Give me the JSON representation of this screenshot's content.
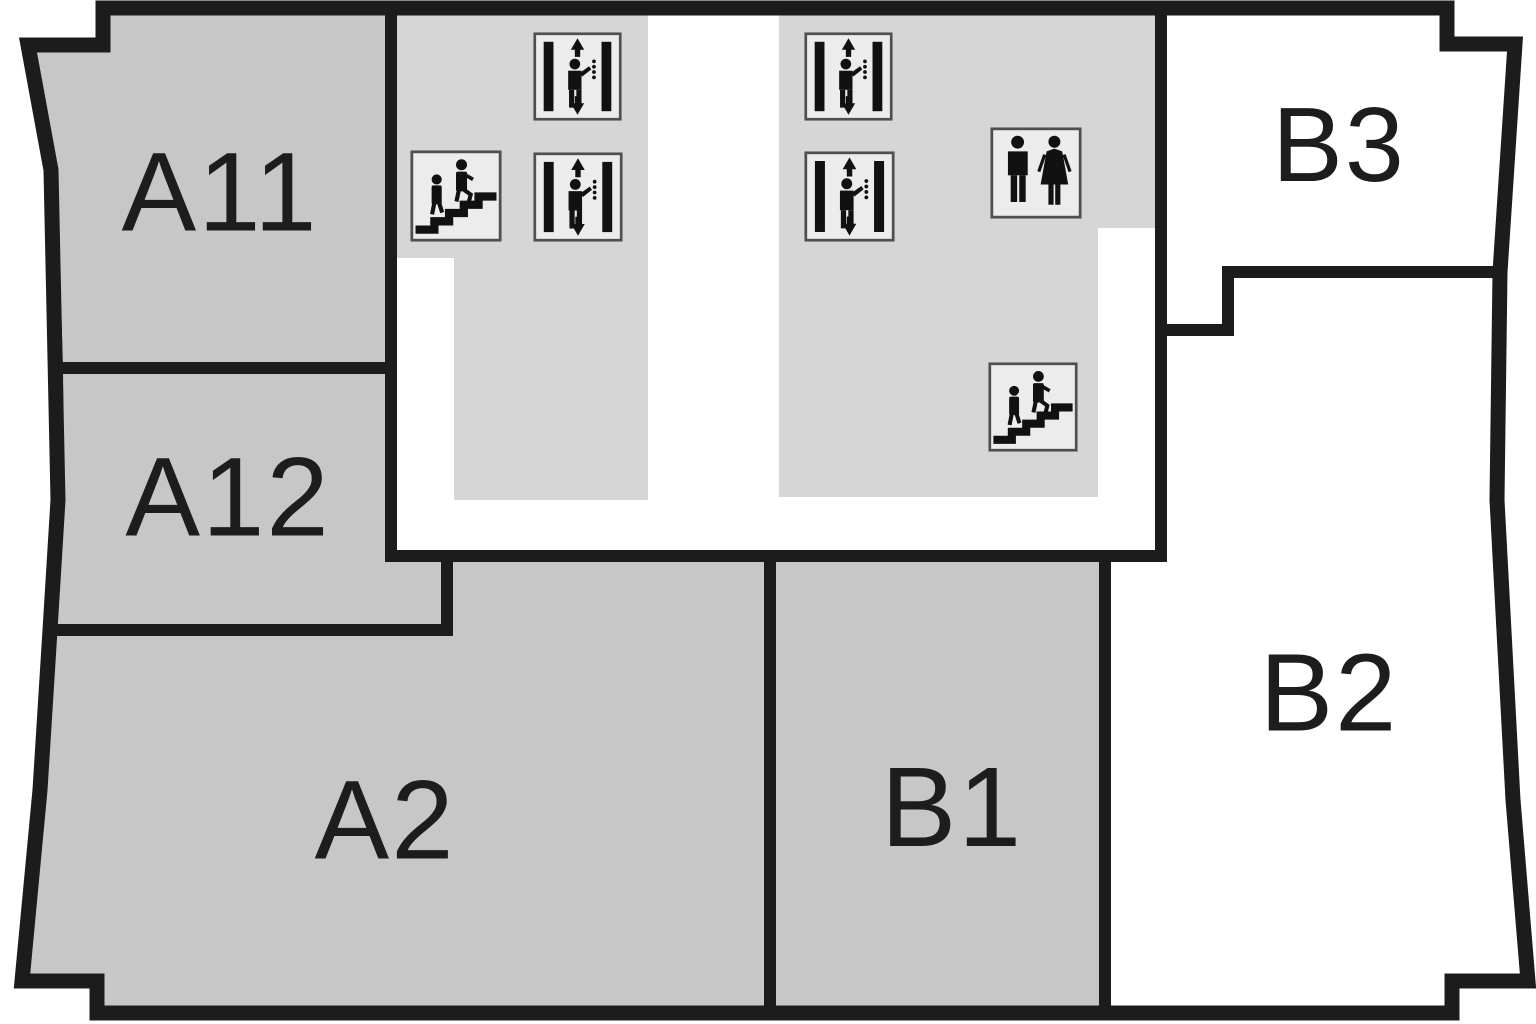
{
  "canvas": {
    "width": 1536,
    "height": 1024,
    "background": "#ffffff"
  },
  "colors": {
    "wall": "#1c1c1c",
    "room_fill": "#c7c7c7",
    "hall_fill": "#d6d6d6",
    "white_room_fill": "#ffffff",
    "icon_bg": "#ececec",
    "icon_border": "#4f4f4f",
    "ink": "#111111",
    "label": "#1d1d1d"
  },
  "outline": {
    "points": [
      [
        103,
        8
      ],
      [
        1447,
        8
      ],
      [
        1447,
        44
      ],
      [
        1515,
        44
      ],
      [
        1500,
        272
      ],
      [
        1497,
        500
      ],
      [
        1513,
        800
      ],
      [
        1528,
        981
      ],
      [
        1452,
        981
      ],
      [
        1452,
        1013
      ],
      [
        97,
        1013
      ],
      [
        97,
        981
      ],
      [
        22,
        981
      ],
      [
        40,
        790
      ],
      [
        50,
        630
      ],
      [
        58,
        500
      ],
      [
        51,
        170
      ],
      [
        28,
        45
      ],
      [
        103,
        45
      ]
    ]
  },
  "halls": [
    {
      "name": "hall-west",
      "points": [
        [
          397,
          8
        ],
        [
          648,
          8
        ],
        [
          648,
          500
        ],
        [
          454,
          500
        ],
        [
          454,
          258
        ],
        [
          397,
          258
        ]
      ]
    },
    {
      "name": "hall-east",
      "points": [
        [
          779,
          8
        ],
        [
          1155,
          8
        ],
        [
          1155,
          228
        ],
        [
          1098,
          228
        ],
        [
          1098,
          497
        ],
        [
          779,
          497
        ]
      ]
    }
  ],
  "rooms": [
    {
      "id": "a11",
      "label": "A11",
      "fill": "gray",
      "label_x": 220,
      "label_y": 192,
      "font_size": 112,
      "points": [
        [
          103,
          8
        ],
        [
          391,
          8
        ],
        [
          391,
          368
        ],
        [
          57,
          368
        ],
        [
          51,
          170
        ],
        [
          28,
          45
        ],
        [
          103,
          45
        ]
      ]
    },
    {
      "id": "a12",
      "label": "A12",
      "fill": "gray",
      "label_x": 228,
      "label_y": 497,
      "font_size": 112,
      "points": [
        [
          57,
          368
        ],
        [
          391,
          368
        ],
        [
          391,
          556
        ],
        [
          447,
          556
        ],
        [
          447,
          630
        ],
        [
          50,
          630
        ],
        [
          58,
          500
        ]
      ]
    },
    {
      "id": "a2",
      "label": "A2",
      "fill": "gray",
      "label_x": 385,
      "label_y": 820,
      "font_size": 112,
      "points": [
        [
          50,
          630
        ],
        [
          447,
          630
        ],
        [
          447,
          556
        ],
        [
          770,
          556
        ],
        [
          770,
          1013
        ],
        [
          97,
          1013
        ],
        [
          97,
          981
        ],
        [
          22,
          981
        ],
        [
          40,
          790
        ]
      ]
    },
    {
      "id": "b1",
      "label": "B1",
      "fill": "gray",
      "label_x": 952,
      "label_y": 807,
      "font_size": 113,
      "points": [
        [
          770,
          556
        ],
        [
          1105,
          556
        ],
        [
          1105,
          1013
        ],
        [
          770,
          1013
        ]
      ]
    },
    {
      "id": "b2",
      "label": "B2",
      "fill": "white",
      "label_x": 1329,
      "label_y": 693,
      "font_size": 110,
      "points": [
        [
          1161,
          330
        ],
        [
          1228,
          330
        ],
        [
          1228,
          272
        ],
        [
          1500,
          272
        ],
        [
          1497,
          500
        ],
        [
          1513,
          800
        ],
        [
          1528,
          981
        ],
        [
          1452,
          981
        ],
        [
          1452,
          1013
        ],
        [
          1105,
          1013
        ],
        [
          1105,
          556
        ],
        [
          1161,
          556
        ]
      ]
    },
    {
      "id": "b3",
      "label": "B3",
      "fill": "white",
      "label_x": 1339,
      "label_y": 145,
      "font_size": 106,
      "points": [
        [
          1161,
          8
        ],
        [
          1447,
          8
        ],
        [
          1447,
          44
        ],
        [
          1515,
          44
        ],
        [
          1500,
          272
        ],
        [
          1228,
          272
        ],
        [
          1228,
          330
        ],
        [
          1161,
          330
        ]
      ]
    }
  ],
  "icons": [
    {
      "type": "stairs",
      "name": "stairs-up-icon",
      "x": 410,
      "y": 150,
      "size": 92
    },
    {
      "type": "elevator",
      "name": "elevator-icon",
      "x": 533,
      "y": 32,
      "size": 89
    },
    {
      "type": "elevator",
      "name": "elevator-icon",
      "x": 533,
      "y": 152,
      "size": 90
    },
    {
      "type": "elevator",
      "name": "elevator-icon",
      "x": 804,
      "y": 32,
      "size": 89
    },
    {
      "type": "elevator",
      "name": "elevator-icon",
      "x": 804,
      "y": 151,
      "size": 91
    },
    {
      "type": "restroom",
      "name": "wc-restroom-icon",
      "x": 990,
      "y": 127,
      "size": 92
    },
    {
      "type": "stairs",
      "name": "stairs-up-icon",
      "x": 988,
      "y": 362,
      "size": 90
    }
  ]
}
